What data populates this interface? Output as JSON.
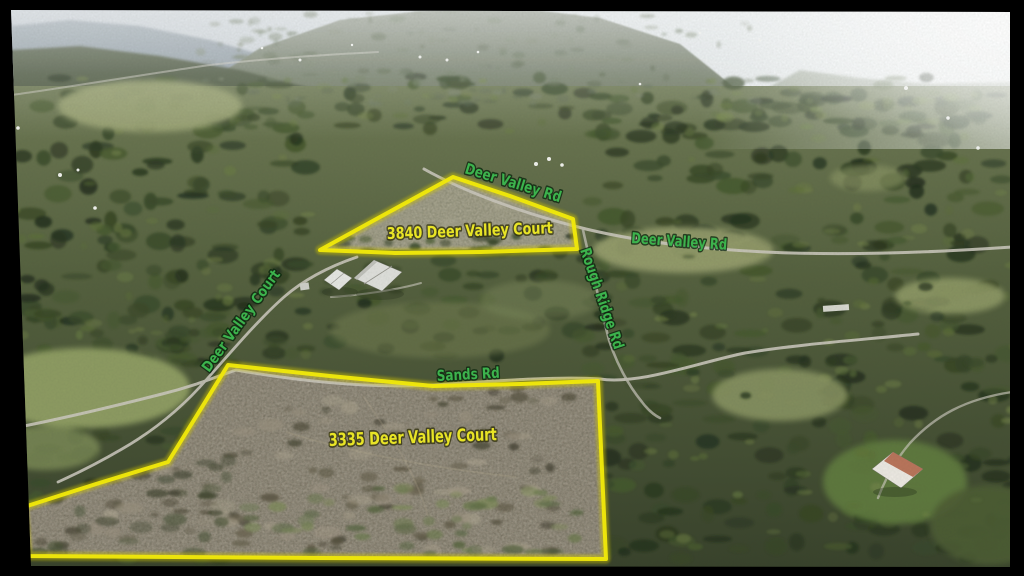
{
  "labels": {
    "roads": [
      {
        "id": "deer-valley-rd-top",
        "text": "Deer Valley Rd"
      },
      {
        "id": "deer-valley-rd-east",
        "text": "Deer Valley Rd"
      },
      {
        "id": "rough-ridge-rd",
        "text": "Rough Ridge Rd"
      },
      {
        "id": "deer-valley-court",
        "text": "Deer Valley Court"
      },
      {
        "id": "sands-rd",
        "text": "Sands Rd"
      }
    ],
    "parcels": [
      {
        "id": "parcel-3840",
        "text": "3840 Deer Valley Court"
      },
      {
        "id": "parcel-3335",
        "text": "3335 Deer Valley Court"
      }
    ]
  },
  "colors": {
    "road_label": "#3cb34d",
    "parcel_label": "#e8e426",
    "boundary_line": "#f0e70a",
    "letterbox": "#000000"
  }
}
